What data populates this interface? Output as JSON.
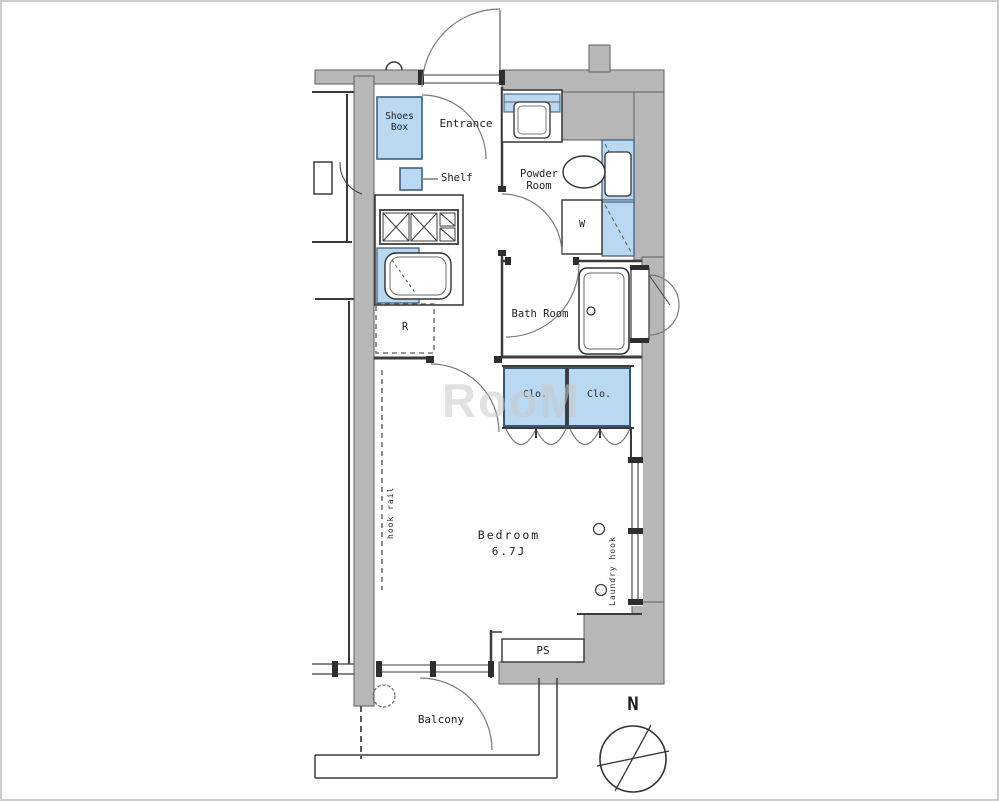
{
  "floorplan": {
    "labels": {
      "shoes_box": "Shoes Box",
      "entrance": "Entrance",
      "shelf": "Shelf",
      "powder_room": "Powder Room",
      "washing_machine": "W",
      "refrigerator": "R",
      "bath_room": "Bath Room",
      "closet_left": "Clo.",
      "closet_right": "Clo.",
      "bedroom": "Bedroom",
      "bedroom_size": "6.7J",
      "hook_rail": "hook rail",
      "laundry_hook": "Laundry hook",
      "pipe_space": "PS",
      "balcony": "Balcony"
    },
    "compass": {
      "north_label": "N"
    },
    "watermark": "RooM",
    "colors": {
      "wall_fill": "#b7b7b7",
      "fixture_blue": "#b9d8f1",
      "line": "#3c3c3c"
    }
  }
}
